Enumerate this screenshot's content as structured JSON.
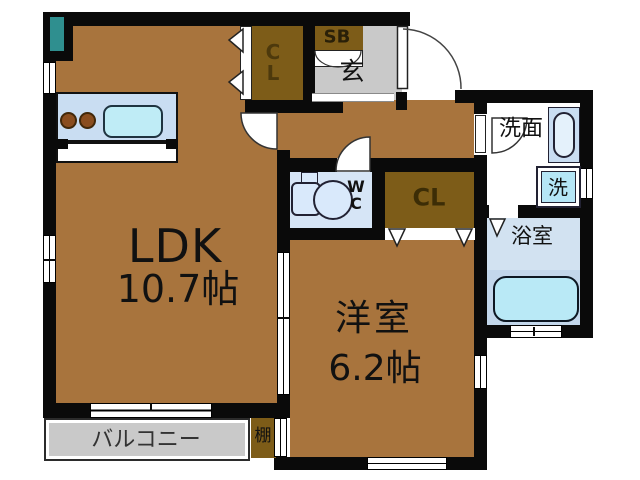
{
  "rooms": {
    "ldk": {
      "name": "LDK",
      "size": "10.7帖"
    },
    "western_room": {
      "name": "洋室",
      "size": "6.2帖"
    },
    "balcony": {
      "label": "バルコニー"
    },
    "shelf": {
      "label": "棚"
    },
    "closet_top": {
      "line1": "C",
      "line2": "L"
    },
    "shoe_box": {
      "label": "SB"
    },
    "entrance": {
      "label": "玄"
    },
    "toilet": {
      "line1": "W",
      "line2": "C"
    },
    "closet_mid": {
      "label": "CL"
    },
    "washroom": {
      "label": "洗面"
    },
    "washing_machine": {
      "label": "洗"
    },
    "bathroom": {
      "label": "浴室"
    }
  },
  "colors": {
    "floor-brown": "#a8743d",
    "closet-brown": "#7d5c18",
    "entrance-gray": "#c9c9c9",
    "wall-black": "#0a0a0a",
    "water-blue": "#d6e5f6",
    "bath-blue": "#d2e2f1",
    "tub-band-blue": "#c3d7eb",
    "tub-cyan": "#b9e9f6",
    "washer-cyan": "#b5e6f6",
    "counter-blue": "#c9ddf2",
    "kitchen-sink-cyan": "#bfecf6",
    "fixture-light-blue": "#d9e9fb",
    "pipe-teal": "#2f8f8f",
    "burner-brown": "#8a4d1f"
  }
}
